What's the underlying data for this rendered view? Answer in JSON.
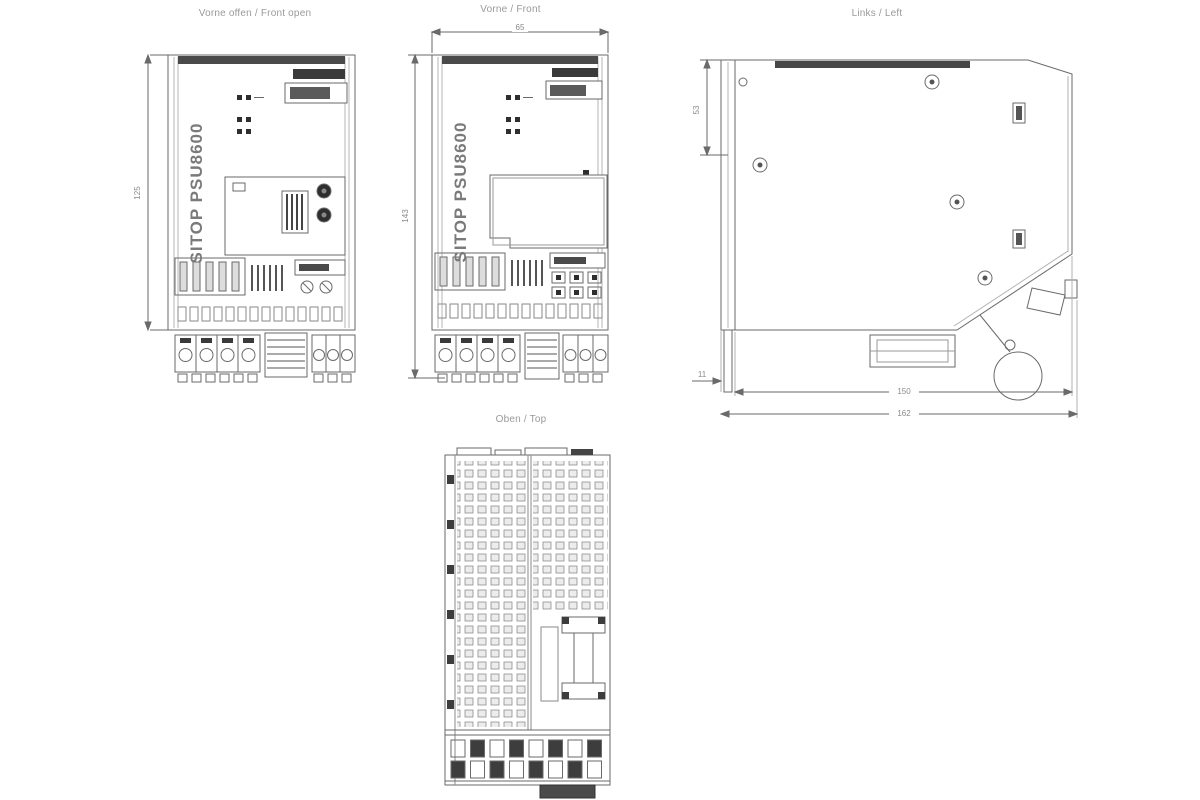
{
  "drawing": {
    "titles": {
      "front_open": "Vorne offen / Front open",
      "front": "Vorne / Front",
      "left": "Links / Left",
      "top": "Oben / Top"
    },
    "product_label": "SITOP PSU8600",
    "dimensions": {
      "front_open_height": "125",
      "front_height": "143",
      "front_width": "65",
      "left_upper_height": "53",
      "left_front_offset": "11",
      "left_depth": "150",
      "left_total_depth": "162"
    },
    "colors": {
      "line": "#6a6a6a",
      "dark_fill": "#3a3a3a",
      "rail": "#b5b5b5",
      "label_text": "#9a9a9a"
    }
  }
}
